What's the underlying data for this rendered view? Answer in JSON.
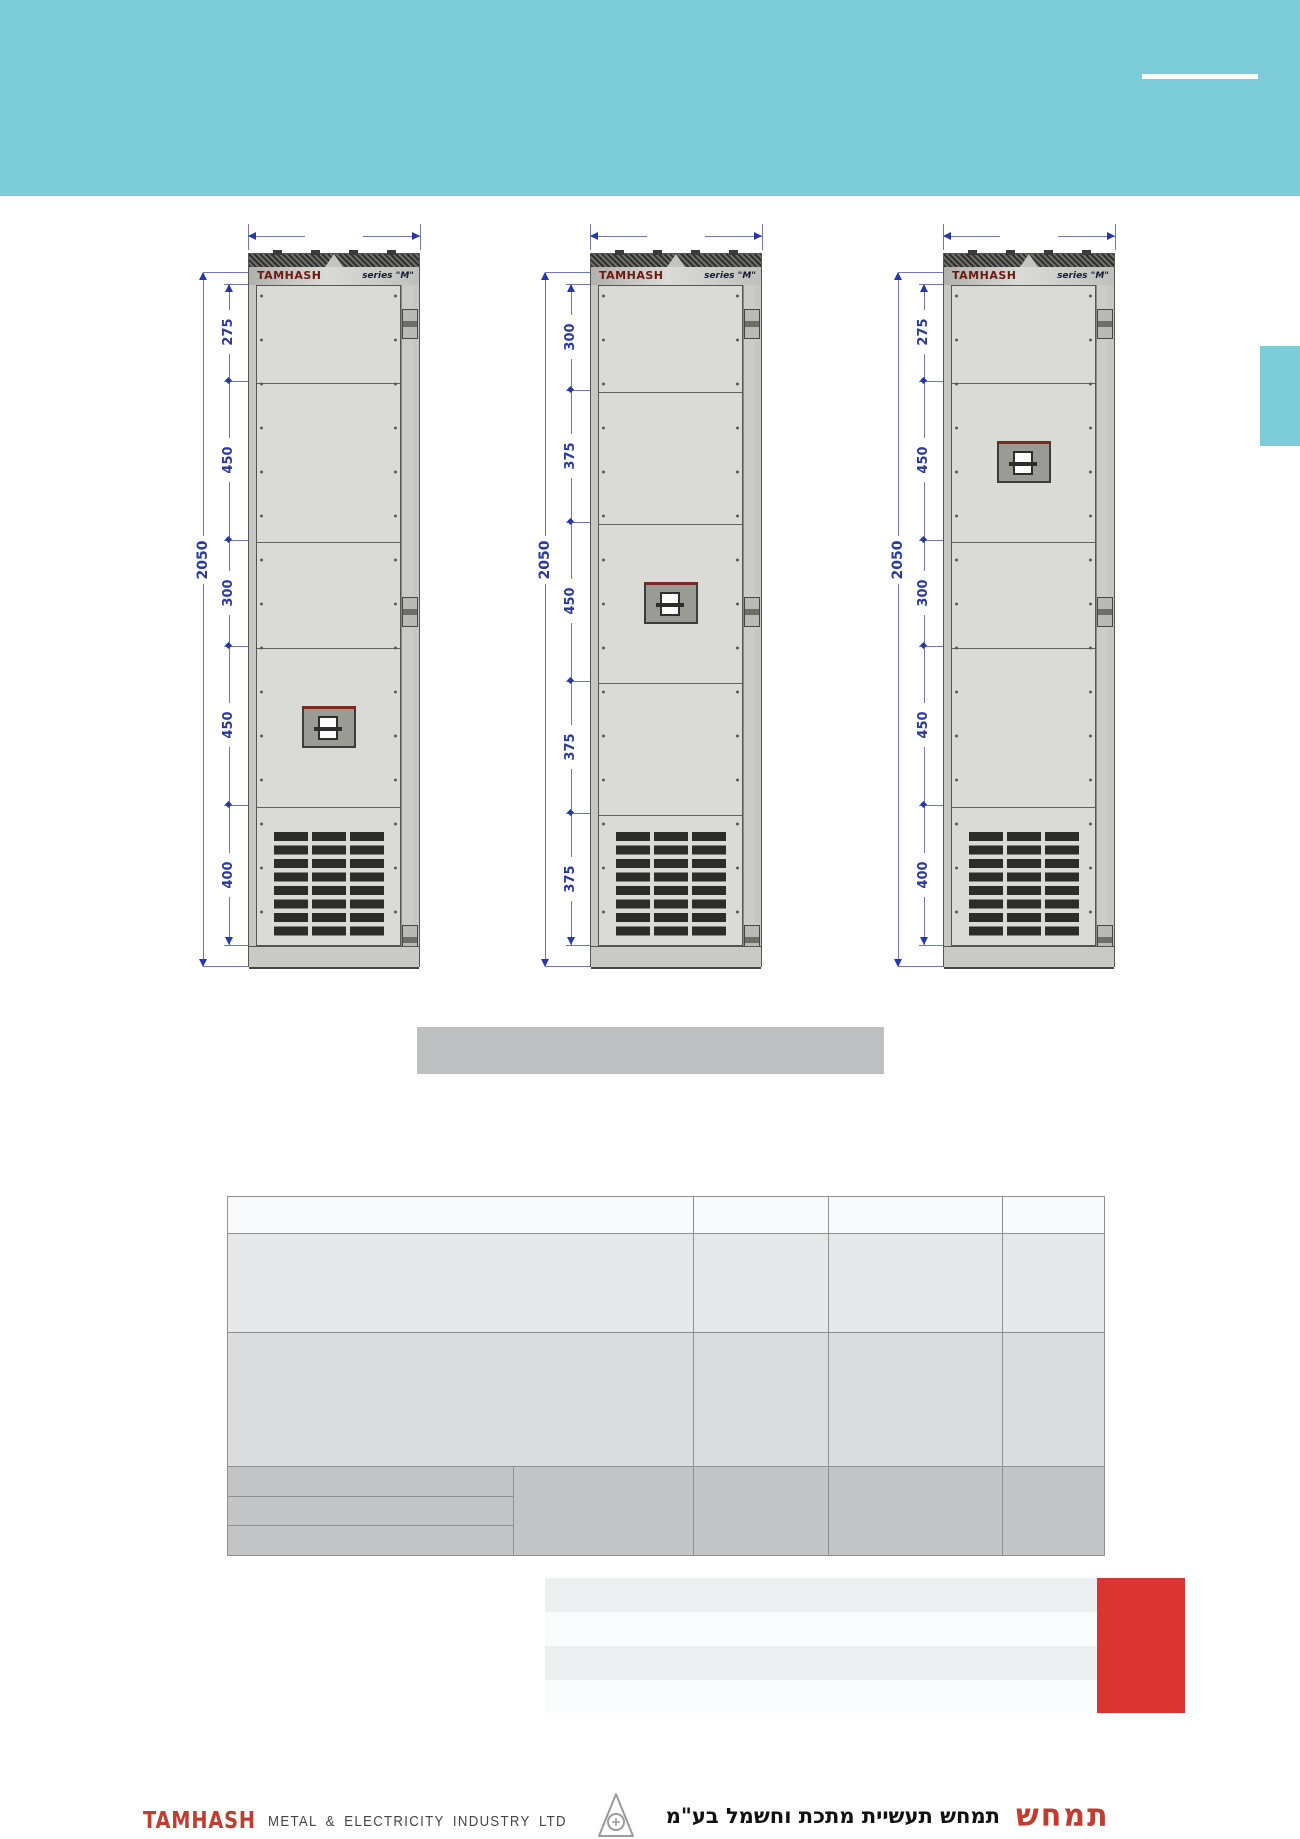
{
  "colors": {
    "header_teal": "#7cccd9",
    "dimension_blue": "#2838a8",
    "cabinet_body_grey": "#d4d5d1",
    "brand_maroon": "#6e1812",
    "red_block": "#dc3531",
    "logo_red": "#c23c30",
    "title_bar_grey": "#bebfc1"
  },
  "cabinets": [
    {
      "brand": "TAMHASH",
      "series": "series \"M\"",
      "overall": "2050",
      "sections": [
        "275",
        "450",
        "300",
        "450",
        "400"
      ]
    },
    {
      "brand": "TAMHASH",
      "series": "series \"M\"",
      "overall": "2050",
      "sections": [
        "300",
        "375",
        "450",
        "375",
        "375"
      ]
    },
    {
      "brand": "TAMHASH",
      "series": "series \"M\"",
      "overall": "2050",
      "sections": [
        "275",
        "450",
        "300",
        "450",
        "400"
      ]
    }
  ],
  "footer": {
    "brand_logo": "TAMHASH",
    "company": "METAL & ELECTRICITY INDUSTRY LTD",
    "hebrew_company": "תמחש תעשיית מתכת וחשמל בע\"מ",
    "hebrew_logo": "תמחש"
  }
}
